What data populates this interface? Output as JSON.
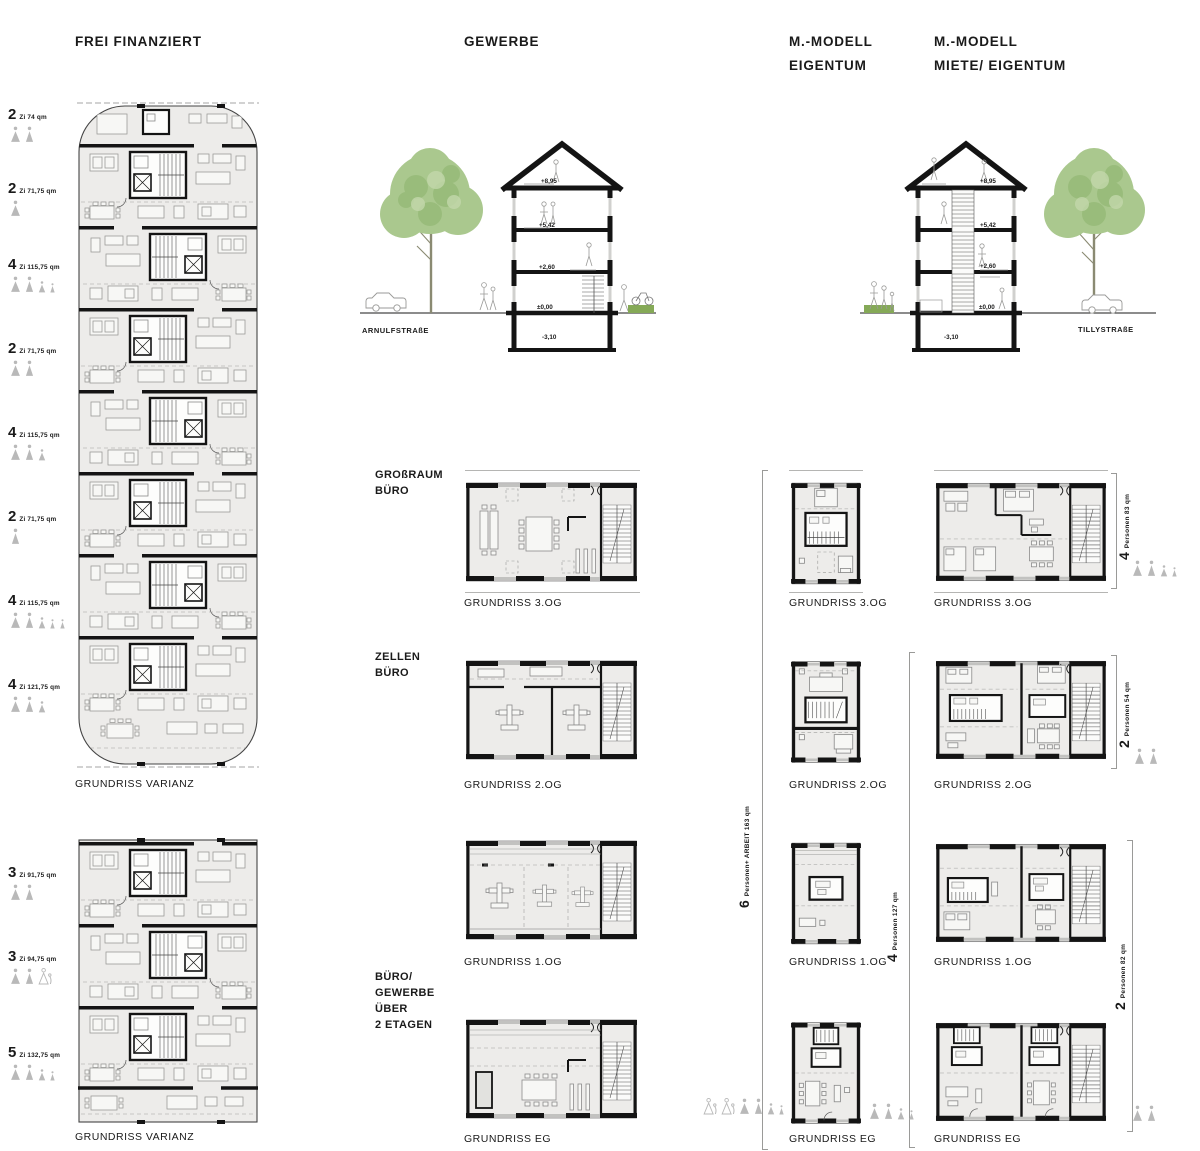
{
  "col1": {
    "title": "FREI FINANZIERT",
    "apartments": [
      {
        "rooms": "2",
        "size": "Zi 74 qm",
        "occupants": [
          "woman",
          "man"
        ]
      },
      {
        "rooms": "2",
        "size": "Zi 71,75 qm",
        "occupants": [
          "woman"
        ]
      },
      {
        "rooms": "4",
        "size": "Zi 115,75 qm",
        "occupants": [
          "woman",
          "man",
          "child",
          "child-sm"
        ]
      },
      {
        "rooms": "2",
        "size": "Zi 71,75 qm",
        "occupants": [
          "woman",
          "man"
        ]
      },
      {
        "rooms": "4",
        "size": "Zi 115,75 qm",
        "occupants": [
          "woman",
          "man",
          "child"
        ]
      },
      {
        "rooms": "2",
        "size": "Zi 71,75 qm",
        "occupants": [
          "man"
        ]
      },
      {
        "rooms": "4",
        "size": "Zi 115,75 qm",
        "occupants": [
          "woman",
          "man",
          "child",
          "child-sm",
          "child-sm"
        ]
      },
      {
        "rooms": "4",
        "size": "Zi 121,75 qm",
        "occupants": [
          "woman",
          "man",
          "child"
        ]
      },
      {
        "rooms": "3",
        "size": "Zi 91,75 qm",
        "occupants": [
          "woman",
          "man"
        ]
      },
      {
        "rooms": "3",
        "size": "Zi 94,75 qm",
        "occupants": [
          "woman",
          "man",
          "adult-baby-outline"
        ]
      },
      {
        "rooms": "5",
        "size": "Zi 132,75 qm",
        "occupants": [
          "woman",
          "man",
          "child",
          "child-sm"
        ]
      }
    ],
    "captions": [
      "GRUNDRISS VARIANZ",
      "GRUNDRISS VARIANZ"
    ]
  },
  "col2": {
    "title": "GEWERBE",
    "section": {
      "street": "ARNULFSTRAßE",
      "levels": [
        "+8,95",
        "+5,42",
        "+2,60",
        "±0,00",
        "-3,10"
      ]
    },
    "use_labels": {
      "grossraum": "GROßRAUM\nBÜRO",
      "zellen": "ZELLEN\nBÜRO",
      "buero": "BÜRO/\nGEWERBE\nÜBER\n2 ETAGEN"
    },
    "captions": [
      "GRUNDRISS 3.OG",
      "GRUNDRISS 2.OG",
      "GRUNDRISS 1.OG",
      "GRUNDRISS EG"
    ]
  },
  "col3": {
    "title": "M.-MODELL\nEIGENTUM",
    "captions": [
      "GRUNDRISS 3.OG",
      "GRUNDRISS 2.OG",
      "GRUNDRISS 1.OG",
      "GRUNDRISS EG"
    ],
    "annotation": {
      "number": "6",
      "text": "Personen+ ARBEIT 163 qm"
    },
    "eg_occupants": [
      "adult-baby-outline",
      "adult-baby-outline",
      "woman",
      "man",
      "child",
      "child-sm"
    ]
  },
  "col4": {
    "title": "M.-MODELL\nMIETE/ EIGENTUM",
    "section": {
      "street": "TILLYSTRAßE",
      "levels": [
        "+8,95",
        "+5,42",
        "+2,60",
        "±0,00",
        "-3,10"
      ]
    },
    "captions": [
      "GRUNDRISS 3.OG",
      "GRUNDRISS 2.OG",
      "GRUNDRISS 1.OG",
      "GRUNDRISS EG"
    ],
    "annotations": [
      {
        "number": "4",
        "text": "Personen 127 qm",
        "occupants": []
      },
      {
        "number": "4",
        "text": "Personen 83 qm",
        "occupants": [
          "woman",
          "man",
          "child",
          "child-sm"
        ]
      },
      {
        "number": "2",
        "text": "Personen 54 qm",
        "occupants": [
          "woman",
          "man"
        ]
      },
      {
        "number": "2",
        "text": "Personen 82 qm",
        "occupants": [
          "woman",
          "man"
        ]
      }
    ],
    "eg_occupants": [
      "woman",
      "man",
      "child",
      "child-sm"
    ]
  },
  "icon_legend": {
    "woman": "gray triangle figure with head dot",
    "man": "gray narrow triangle figure with head dot",
    "child": "small gray triangle figure",
    "adult-baby-outline": "outlined triangle figure carrying infant"
  },
  "colors": {
    "wall": "#141414",
    "plan_fill": "#edecea",
    "furniture": "#9a9a98",
    "icon_gray": "#b9b9b9",
    "tree_green": "#aac88e",
    "hedge_green": "#85a957"
  }
}
